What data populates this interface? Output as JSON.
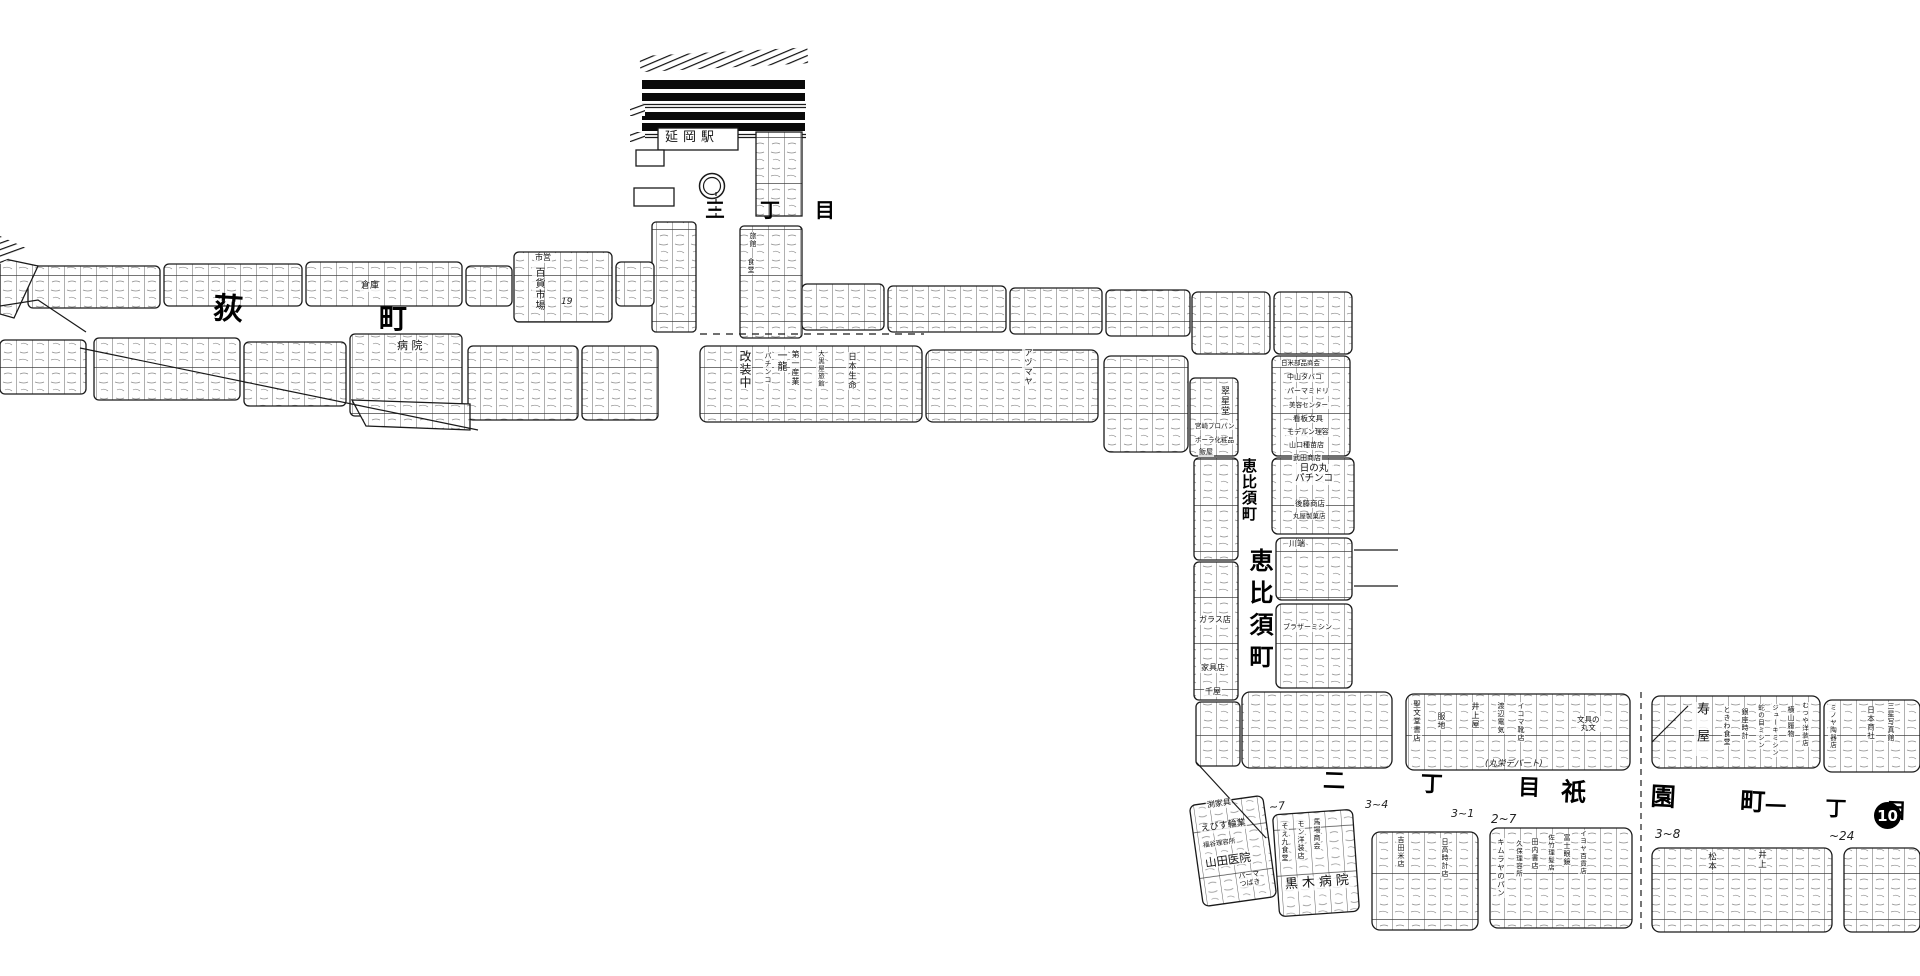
{
  "streets": {
    "hagi": "荻",
    "machi": "町",
    "sanchome": "三 丁 目",
    "ebisu_small": "恵比須町",
    "ebisu_large": "恵比須町",
    "nichome": "二 丁 目",
    "gion": "祇 園 町",
    "itchome": "一 丁 目",
    "badge10": "10"
  },
  "station": {
    "name": "延岡駅"
  },
  "annotations": {
    "n19": "19",
    "n7": "~7",
    "n34": "3~4",
    "n31": "3~1",
    "n27": "2~7",
    "n38": "3~8",
    "n24": "~24"
  },
  "shops": {
    "soko": "倉庫",
    "shiei": "市営",
    "hyakka_ichiba": "百貨市場",
    "byoin": "病 院",
    "ryokan": "旅館",
    "shokudo": "食堂",
    "kaisochu": "改装中",
    "ichiryu": "一龍",
    "pachinko": "パチンコ",
    "daiichi_sangyo": "第一産業",
    "daikokuya": "大黒屋旅館",
    "nihon_seimei": "日本生命",
    "azumaya": "アヅマヤ",
    "suiseido": "翠星堂",
    "miyazaki_propane": "宮崎プロパン",
    "pola": "ポーラ化粧品",
    "hanya": "飯屋",
    "nichibei_buhin": "日米部品商会",
    "nakayama_tabako": "中山タバコ",
    "perma_midori": "パーマミドリ",
    "biyo_center": "美容センター",
    "kanban_bungu": "看板文具",
    "modern_riyo": "モデルン理容",
    "yamaguchi_shubyo": "山口種苗店",
    "takeda_shoten": "武田商店",
    "hinomaru_pachinko": "日の丸\nパチンコ",
    "goto_shoten": "後藤商店",
    "maruya_seika": "丸屋製菓店",
    "kawabata": "川端",
    "brother_mishin": "ブラザーミシン",
    "glass_ten": "ガラス店",
    "kagu_ten": "家具店",
    "senya": "千屋",
    "fuchi_kagu": "渕家具",
    "ebisu_ringyo": "えびす輪業",
    "fukutani_riyosho": "福谷理容所",
    "yamada_iin": "山田医院",
    "perma_tsubaki": "パーマ\nつばき",
    "soeku_shokudo": "そえ九食堂",
    "mon_yosoten": "モン洋装店",
    "baba_shokai": "馬場商会",
    "kuroki_byoin": "黒木病院",
    "yoshida_kometen": "吉田米店",
    "hidaka_tokeiten": "日高時計店",
    "kimuraya_pan": "キムラヤのパン",
    "kubo_riyosho": "久保理容所",
    "tauchi_shoten": "田内書店",
    "satake_rihatsu": "佐竹理髪店",
    "fuji_megane": "富士眼鏡",
    "iyoya_hyakka": "イヨヤ百貨店",
    "seibundo_shoten": "聖文堂書店",
    "fukuji": "服地",
    "inoueya": "井上屋",
    "watanabe_denki": "渡辺電気",
    "ikoma_kutsuten": "イコマ靴店",
    "bungu_no_marubun": "文具の\n丸文",
    "maruei_depato": "(丸栄デパート)",
    "kotobukiya": "寿屋",
    "tokiwa_shokudo": "ときわ食堂",
    "ginza_tokei": "銀座時計",
    "janome_mishin": "蛇の目ミシン",
    "juki_mishin": "ジューキミシン",
    "yokoyama_hakimono": "横山履物",
    "mutsuya_yosoten": "むつや洋装店",
    "minoya_tokiten": "ミノヤ陶器店",
    "nihon_shosha": "日本商社",
    "sansei_shashinkan": "三星写真館",
    "matsumoto": "松本",
    "inoue": "井上"
  }
}
